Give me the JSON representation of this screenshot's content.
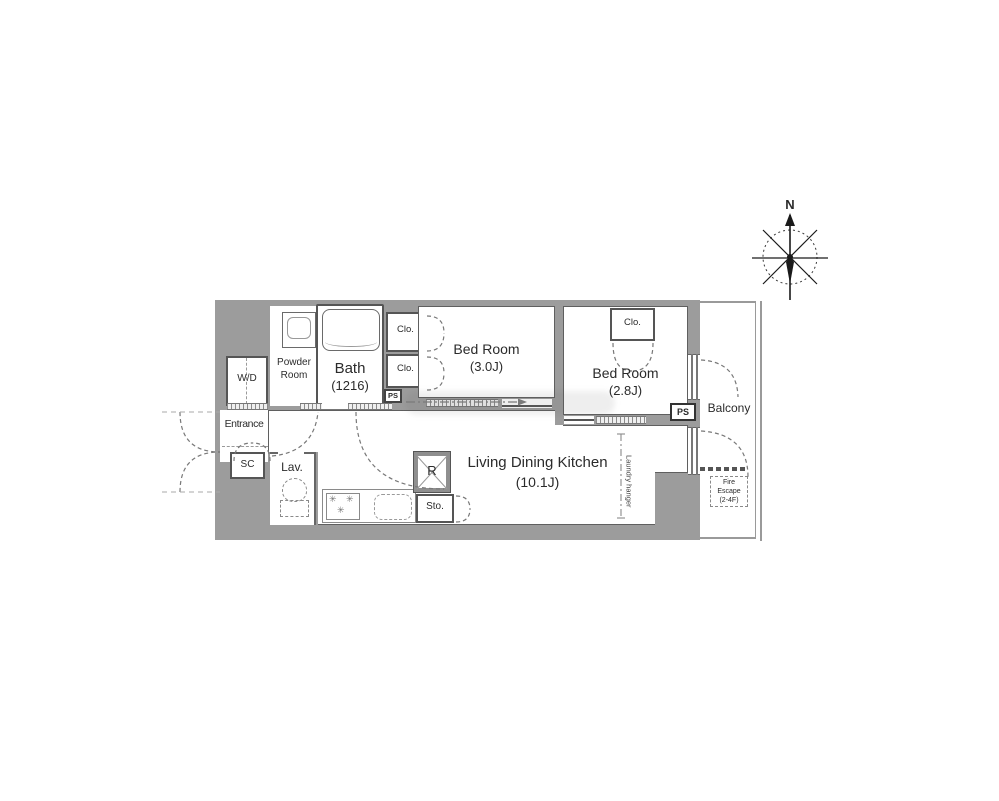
{
  "compass": {
    "north": "N"
  },
  "plan": {
    "wd": "W/D",
    "powder_line1": "Powder",
    "powder_line2": "Room",
    "bath_name": "Bath",
    "bath_size": "(1216)",
    "clo1": "Clo.",
    "clo2": "Clo.",
    "clo3": "Clo.",
    "bed1_name": "Bed Room",
    "bed1_size": "(3.0J)",
    "bed2_name": "Bed Room",
    "bed2_size": "(2.8J)",
    "entrance": "Entrance",
    "sc": "SC",
    "lav": "Lav.",
    "ldk_name": "Living Dining Kitchen",
    "ldk_size": "(10.1J)",
    "refrigerator": "R",
    "storage": "Sto.",
    "ps_small": "PS",
    "ps_balcony": "PS",
    "balcony": "Balcony",
    "fire_line1": "Fire",
    "fire_line2": "Escape",
    "fire_line3": "(2-4F)",
    "laundry_hanger": "Laundry hanger"
  },
  "colors": {
    "wall": "#9c9c9c",
    "line": "#5f5f5f",
    "floor": "#ffffff"
  }
}
